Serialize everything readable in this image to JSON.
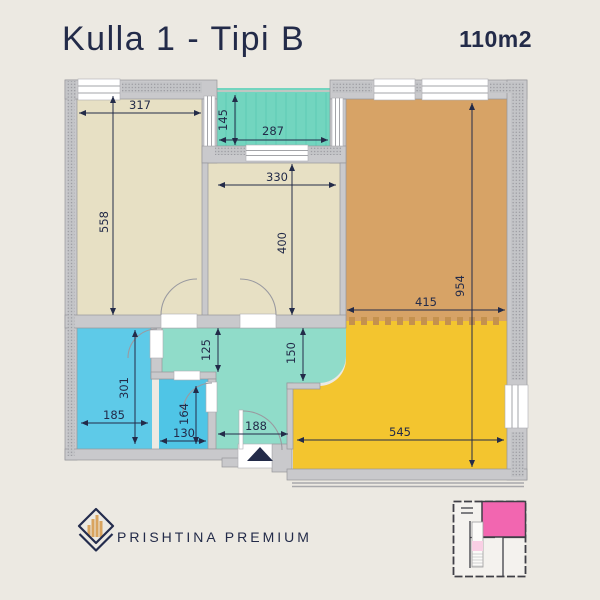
{
  "header": {
    "title": "Kulla 1 - Tipi B",
    "area": "110m2"
  },
  "plan": {
    "dims": {
      "bedroom1_width": "317",
      "bedroom1_length": "558",
      "balcony_depth": "145",
      "balcony_width": "287",
      "bedroom2_width": "330",
      "bedroom2_length": "400",
      "living_width": "415",
      "living_length": "954",
      "hall_width_left": "125",
      "hall_width_right": "150",
      "bathroom_width": "185",
      "bathroom_length": "301",
      "wc_width": "130",
      "wc_length": "164",
      "entry_width": "188",
      "kitchen_width": "545"
    }
  },
  "branding": {
    "logo_text": "PRISHTINA PREMIUM"
  },
  "colors": {
    "background": "#ECE9E2",
    "ink": "#232B49",
    "bedroom": "#E7E0C4",
    "balcony": "#72D5BF",
    "hall": "#90DCC9",
    "living": "#D7A366",
    "kitchen_yellow": "#F3C52F",
    "bathroom": "#5ECAE8",
    "wc": "#4FC5E6",
    "wall": "#C9C9CC",
    "window": "#FFFFFF",
    "dash_divider": "#C4914E",
    "logo_gold": "#D9A45F",
    "minimap_highlight": "#F266B0"
  }
}
